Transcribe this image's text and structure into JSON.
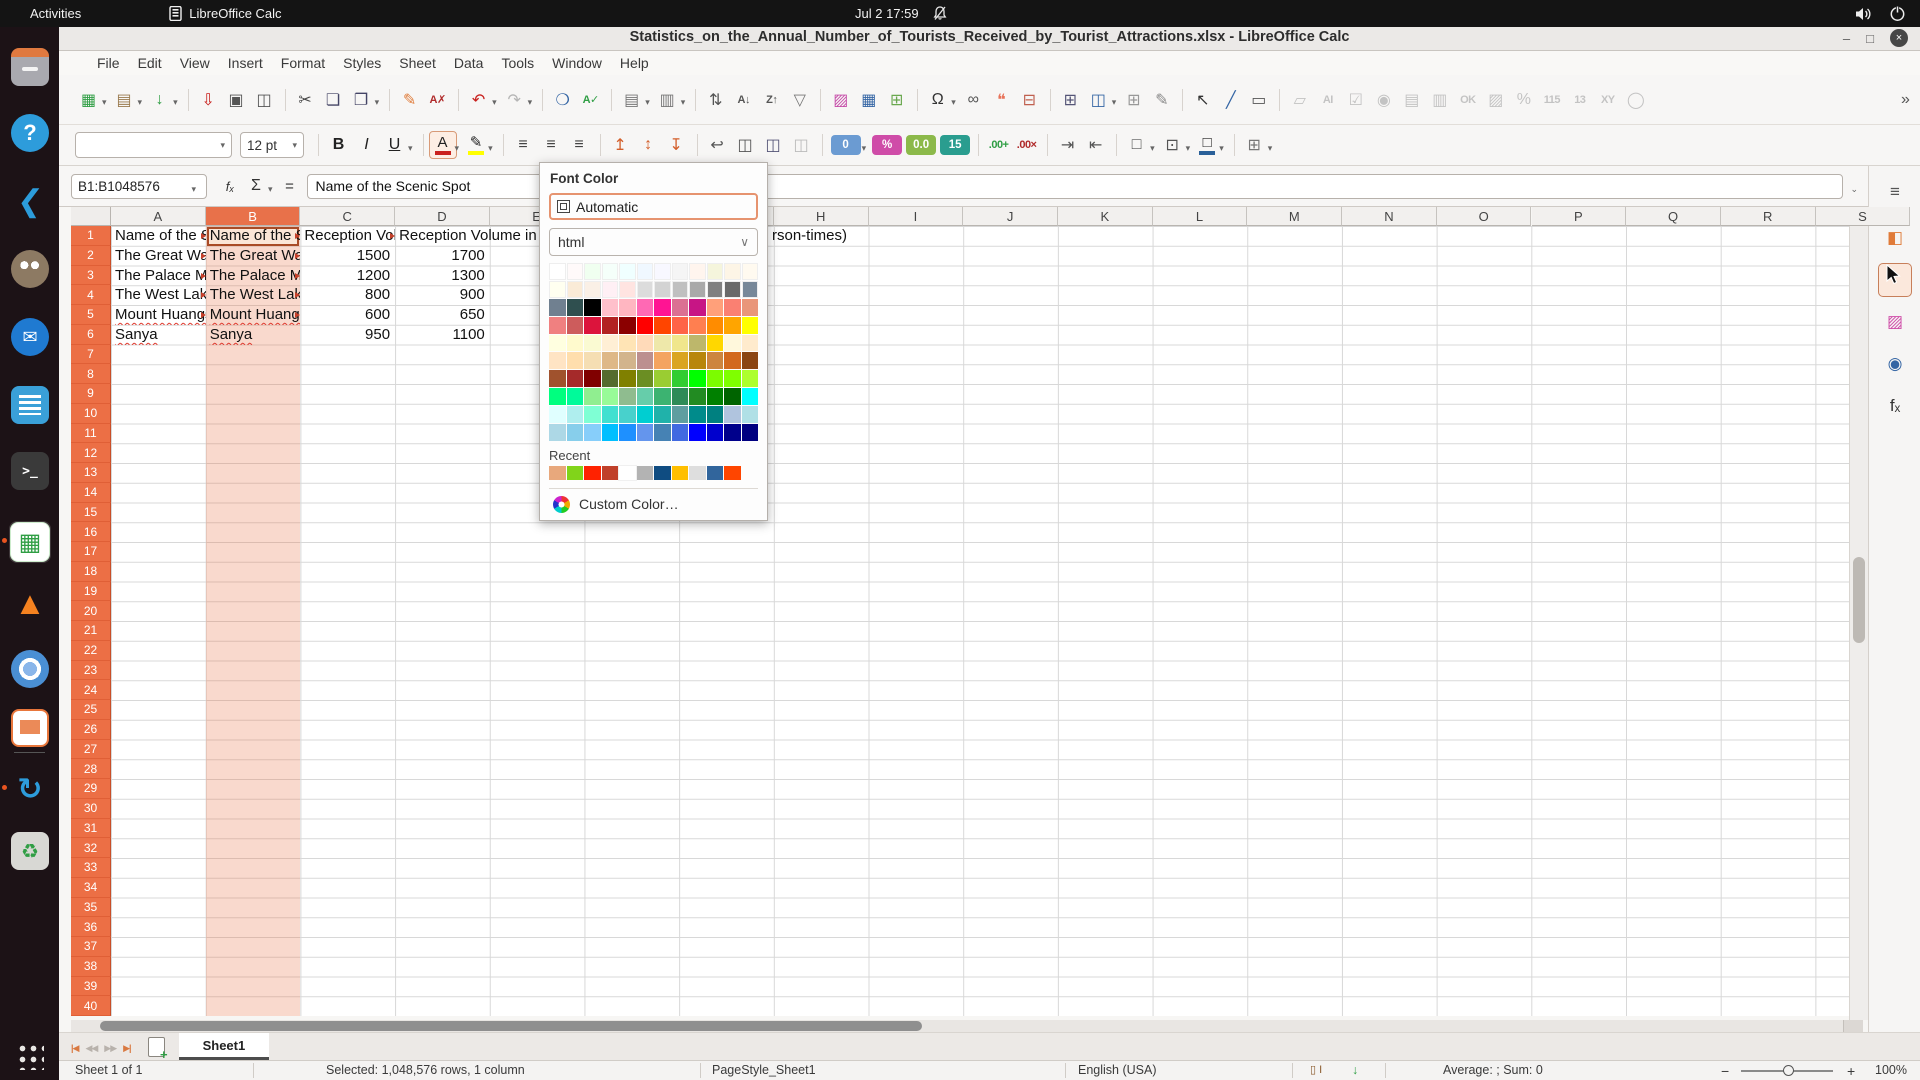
{
  "topbar": {
    "activities": "Activities",
    "app_name": "LibreOffice Calc",
    "clock": "Jul 2 17:59"
  },
  "titlebar": {
    "title": "Statistics_on_the_Annual_Number_of_Tourists_Received_by_Tourist_Attractions.xlsx - LibreOffice Calc",
    "minimize": "–",
    "maximize": "□",
    "close": "×"
  },
  "menubar": {
    "items": [
      "File",
      "Edit",
      "View",
      "Insert",
      "Format",
      "Styles",
      "Sheet",
      "Data",
      "Tools",
      "Window",
      "Help"
    ]
  },
  "toolbar_main": {
    "items": [
      {
        "name": "new",
        "glyph": "▦",
        "color": "#2f9e44",
        "dd": true
      },
      {
        "name": "open",
        "glyph": "▤",
        "color": "#9a7b4f",
        "dd": true
      },
      {
        "name": "save",
        "glyph": "↓",
        "color": "#2f9e44",
        "dd": true
      },
      {
        "name": "sep"
      },
      {
        "name": "export-pdf",
        "glyph": "⇩",
        "color": "#c9211e"
      },
      {
        "name": "print",
        "glyph": "▣",
        "color": "#555"
      },
      {
        "name": "print-preview",
        "glyph": "◫",
        "color": "#555"
      },
      {
        "name": "sep"
      },
      {
        "name": "cut",
        "glyph": "✂",
        "color": "#444"
      },
      {
        "name": "copy",
        "glyph": "❏",
        "color": "#446"
      },
      {
        "name": "paste",
        "glyph": "❐",
        "color": "#446",
        "dd": true
      },
      {
        "name": "sep"
      },
      {
        "name": "clone-formatting",
        "glyph": "✎",
        "color": "#e07b39"
      },
      {
        "name": "clear-formatting",
        "glyph": "A✗",
        "color": "#b02b2b",
        "small": true
      },
      {
        "name": "sep"
      },
      {
        "name": "undo",
        "glyph": "↶",
        "color": "#c9211e",
        "dd": true
      },
      {
        "name": "redo",
        "glyph": "↷",
        "color": "#aaa",
        "dd": true,
        "disabled": true
      },
      {
        "name": "sep"
      },
      {
        "name": "find-replace",
        "glyph": "❍",
        "color": "#3465a4"
      },
      {
        "name": "spelling",
        "glyph": "A✓",
        "color": "#2f9e44",
        "small": true
      },
      {
        "name": "sep"
      },
      {
        "name": "row",
        "glyph": "▤",
        "color": "#777",
        "dd": true
      },
      {
        "name": "column",
        "glyph": "▥",
        "color": "#777",
        "dd": true
      },
      {
        "name": "sep"
      },
      {
        "name": "sort",
        "glyph": "⇅",
        "color": "#555"
      },
      {
        "name": "sort-ascending",
        "glyph": "A↓",
        "color": "#555",
        "small": true
      },
      {
        "name": "sort-descending",
        "glyph": "Z↑",
        "color": "#555",
        "small": true
      },
      {
        "name": "autofilter",
        "glyph": "▽",
        "color": "#777"
      },
      {
        "name": "sep"
      },
      {
        "name": "insert-image",
        "glyph": "▨",
        "color": "#c64ca8"
      },
      {
        "name": "insert-chart",
        "glyph": "▦",
        "color": "#3465a4"
      },
      {
        "name": "pivot-table",
        "glyph": "⊞",
        "color": "#6aa84f"
      },
      {
        "name": "sep"
      },
      {
        "name": "special-character",
        "glyph": "Ω",
        "color": "#333",
        "dd": true
      },
      {
        "name": "hyperlink",
        "glyph": "∞",
        "color": "#555"
      },
      {
        "name": "comment",
        "glyph": "❝",
        "color": "#e8735a"
      },
      {
        "name": "headers-footers",
        "glyph": "⊟",
        "color": "#c0604f"
      },
      {
        "name": "sep"
      },
      {
        "name": "freeze-panes",
        "glyph": "⊞",
        "color": "#557"
      },
      {
        "name": "split-window",
        "glyph": "◫",
        "color": "#3465a4",
        "dd": true
      },
      {
        "name": "show-grid",
        "glyph": "⊞",
        "color": "#999"
      },
      {
        "name": "show-draw-functions",
        "glyph": "✎",
        "color": "#888"
      },
      {
        "name": "sep"
      },
      {
        "name": "select",
        "glyph": "↖",
        "color": "#333"
      },
      {
        "name": "insert-line",
        "glyph": "╱",
        "color": "#3465a4"
      },
      {
        "name": "insert-text-box",
        "glyph": "▭",
        "color": "#555"
      },
      {
        "name": "sep"
      },
      {
        "name": "label-field",
        "glyph": "▱",
        "color": "#bbb",
        "disabled": true
      },
      {
        "name": "text-box-field",
        "glyph": "AI",
        "color": "#bbb",
        "disabled": true,
        "small": true
      },
      {
        "name": "check-box",
        "glyph": "☑",
        "color": "#bbb",
        "disabled": true
      },
      {
        "name": "option-button",
        "glyph": "◉",
        "color": "#bbb",
        "disabled": true
      },
      {
        "name": "list-box",
        "glyph": "▤",
        "color": "#bbb",
        "disabled": true
      },
      {
        "name": "combo-box",
        "glyph": "▥",
        "color": "#bbb",
        "disabled": true
      },
      {
        "name": "push-button",
        "glyph": "OK",
        "color": "#bbb",
        "disabled": true,
        "small": true
      },
      {
        "name": "image-button",
        "glyph": "▨",
        "color": "#bbb",
        "disabled": true
      },
      {
        "name": "percent-field",
        "glyph": "%",
        "color": "#bbb",
        "disabled": true
      },
      {
        "name": "numeric-field",
        "glyph": "115",
        "color": "#bbb",
        "disabled": true,
        "small": true
      },
      {
        "name": "date-field",
        "glyph": "13",
        "color": "#bbb",
        "disabled": true,
        "small": true
      },
      {
        "name": "formatted-field",
        "glyph": "XY",
        "color": "#bbb",
        "disabled": true,
        "small": true
      },
      {
        "name": "more-controls",
        "glyph": "◯",
        "color": "#bbb",
        "disabled": true
      },
      {
        "name": "spacer"
      },
      {
        "name": "toolbar-overflow",
        "glyph": "»",
        "color": "#555"
      }
    ]
  },
  "toolbar_format": {
    "font_name_value": "",
    "font_size_value": "12 pt",
    "items": [
      {
        "type": "combo",
        "name": "font-name",
        "width": 157
      },
      {
        "type": "combo",
        "name": "font-size",
        "width": 64
      },
      {
        "type": "sep"
      },
      {
        "type": "icon",
        "name": "bold",
        "glyph": "B",
        "color": "#222",
        "cls": "b"
      },
      {
        "type": "icon",
        "name": "italic",
        "glyph": "I",
        "color": "#222",
        "cls": "i"
      },
      {
        "type": "icon",
        "name": "underline",
        "glyph": "U",
        "color": "#222",
        "cls": "u",
        "dd": true
      },
      {
        "type": "sep"
      },
      {
        "type": "colorbtn",
        "name": "font-color",
        "glyph": "A",
        "bar": "#c9211e",
        "dd": true,
        "active": true
      },
      {
        "type": "colorbtn",
        "name": "highlight-color",
        "glyph": "✎",
        "bar": "#ffff00",
        "dd": true
      },
      {
        "type": "sep"
      },
      {
        "type": "icon",
        "name": "align-left",
        "glyph": "≡",
        "color": "#444"
      },
      {
        "type": "icon",
        "name": "align-center",
        "glyph": "≡",
        "color": "#444"
      },
      {
        "type": "icon",
        "name": "align-right",
        "glyph": "≡",
        "color": "#444"
      },
      {
        "type": "sep"
      },
      {
        "type": "icon",
        "name": "align-top",
        "glyph": "↥",
        "color": "#d35f2b"
      },
      {
        "type": "icon",
        "name": "center-vertically",
        "glyph": "↕",
        "color": "#d35f2b"
      },
      {
        "type": "icon",
        "name": "align-bottom",
        "glyph": "↧",
        "color": "#d35f2b"
      },
      {
        "type": "sep"
      },
      {
        "type": "icon",
        "name": "wrap-text",
        "glyph": "↩",
        "color": "#555"
      },
      {
        "type": "icon",
        "name": "merge-cells",
        "glyph": "◫",
        "color": "#555"
      },
      {
        "type": "icon",
        "name": "merge-and-center",
        "glyph": "◫",
        "color": "#557"
      },
      {
        "type": "icon",
        "name": "unmerge-cells",
        "glyph": "◫",
        "color": "#bbb",
        "disabled": true
      },
      {
        "type": "sep"
      },
      {
        "type": "chip",
        "name": "format-number",
        "text": "0",
        "bg": "#6b9bd2",
        "dd": true
      },
      {
        "type": "chip",
        "name": "format-percent",
        "text": "%",
        "bg": "#cf4ca8"
      },
      {
        "type": "chip",
        "name": "format-decimal",
        "text": "0.0",
        "bg": "#8cb94a"
      },
      {
        "type": "chip",
        "name": "format-date",
        "text": "15",
        "bg": "#2a9d8f"
      },
      {
        "type": "sep"
      },
      {
        "type": "icon",
        "name": "add-decimal-place",
        "glyph": ".00+",
        "color": "#2f9e44",
        "small": true
      },
      {
        "type": "icon",
        "name": "delete-decimal-place",
        "glyph": ".00×",
        "color": "#b02b2b",
        "small": true
      },
      {
        "type": "sep"
      },
      {
        "type": "icon",
        "name": "increase-indent",
        "glyph": "⇥",
        "color": "#555"
      },
      {
        "type": "icon",
        "name": "decrease-indent",
        "glyph": "⇤",
        "color": "#555"
      },
      {
        "type": "sep"
      },
      {
        "type": "icon",
        "name": "borders",
        "glyph": "□",
        "color": "#555",
        "dd": true
      },
      {
        "type": "icon",
        "name": "border-style",
        "glyph": "⊡",
        "color": "#555",
        "dd": true
      },
      {
        "type": "colorbtn",
        "name": "border-color",
        "glyph": "□",
        "bar": "#2a6099",
        "dd": true
      },
      {
        "type": "sep"
      },
      {
        "type": "icon",
        "name": "conditional-formatting",
        "glyph": "⊞",
        "color": "#777",
        "dd": true
      }
    ]
  },
  "formula_bar": {
    "cell_reference": "B1:B1048576",
    "fx_label": "fₓ",
    "sum_label": "Σ",
    "equals_label": "=",
    "content": "Name of the Scenic Spot"
  },
  "font_color_popup": {
    "title": "Font Color",
    "automatic_label": "Automatic",
    "palette_name": "html",
    "palette": [
      [
        "#FFFFFF",
        "#FFFAFA",
        "#F0FFF0",
        "#F5FFFA",
        "#F0FFFF",
        "#F0F8FF",
        "#F8F8FF",
        "#F5F5F5",
        "#FFF5EE",
        "#F5F5DC",
        "#FDF5E6",
        "#FFFAF0"
      ],
      [
        "#FFFFF0",
        "#FAEBD7",
        "#FAF0E6",
        "#FFF0F5",
        "#FFE4E1",
        "#DCDCDC",
        "#D3D3D3",
        "#C0C0C0",
        "#A9A9A9",
        "#808080",
        "#696969",
        "#778899"
      ],
      [
        "#708090",
        "#2F4F4F",
        "#000000",
        "#FFC0CB",
        "#FFB6C1",
        "#FF69B4",
        "#FF1493",
        "#DB7093",
        "#C71585",
        "#FFA07A",
        "#FA8072",
        "#E9967A"
      ],
      [
        "#F08080",
        "#CD5C5C",
        "#DC143C",
        "#B22222",
        "#8B0000",
        "#FF0000",
        "#FF4500",
        "#FF6347",
        "#FF7F50",
        "#FF8C00",
        "#FFA500",
        "#FFFF00"
      ],
      [
        "#FFFFE0",
        "#FFFACD",
        "#FAFAD2",
        "#FFEFD5",
        "#FFE4B5",
        "#FFDAB9",
        "#EEE8AA",
        "#F0E68C",
        "#BDB76B",
        "#FFD700",
        "#FFF8DC",
        "#FFEBCD"
      ],
      [
        "#FFE4C4",
        "#FFDEAD",
        "#F5DEB3",
        "#DEB887",
        "#D2B48C",
        "#BC8F8F",
        "#F4A460",
        "#DAA520",
        "#B8860B",
        "#CD853F",
        "#D2691E",
        "#8B4513"
      ],
      [
        "#A0522D",
        "#A52A2A",
        "#800000",
        "#556B2F",
        "#808000",
        "#6B8E23",
        "#9ACD32",
        "#32CD32",
        "#00FF00",
        "#7CFC00",
        "#7FFF00",
        "#ADFF2F"
      ],
      [
        "#00FF7F",
        "#00FA9A",
        "#90EE90",
        "#98FB98",
        "#8FBC8F",
        "#66CDAA",
        "#3CB371",
        "#2E8B57",
        "#228B22",
        "#008000",
        "#006400",
        "#00FFFF"
      ],
      [
        "#E0FFFF",
        "#AFEEEE",
        "#7FFFD4",
        "#40E0D0",
        "#48D1CC",
        "#00CED1",
        "#20B2AA",
        "#5F9EA0",
        "#008B8B",
        "#008080",
        "#B0C4DE",
        "#B0E0E6"
      ],
      [
        "#ADD8E6",
        "#87CEEB",
        "#87CEFA",
        "#00BFFF",
        "#1E90FF",
        "#6495ED",
        "#4682B4",
        "#4169E1",
        "#0000FF",
        "#0000CD",
        "#00008B",
        "#000080"
      ]
    ],
    "recent_label": "Recent",
    "recent": [
      "#E8A87C",
      "#81D41A",
      "#FF2200",
      "#C0402A",
      "#FFFFFF",
      "#B3B3B3",
      "#0F4C81",
      "#FFBF00",
      "#DEDEDE",
      "#31659C",
      "#FF4500"
    ],
    "custom_label": "Custom Color…"
  },
  "sheet": {
    "columns": [
      "A",
      "B",
      "C",
      "D",
      "E",
      "F",
      "G",
      "H",
      "I",
      "J",
      "K",
      "L",
      "M",
      "N",
      "O",
      "P",
      "Q",
      "R",
      "S"
    ],
    "selected_column": "B",
    "visible_rows": 40,
    "data": {
      "names": [
        "Name of the Scenic Spot",
        "The Great Wall",
        "The Palace Museum",
        "The West Lake",
        "Mount Huangshan",
        "Sanya"
      ],
      "c_values": [
        "Reception Volume in 2016(10,000 person-times)",
        "1500",
        "1200",
        "800",
        "600",
        "950"
      ],
      "d_values": [
        "Reception Volume in 2017(10,000 person-times)",
        "1700",
        "1300",
        "900",
        "650",
        "1100"
      ],
      "d1_visible_tail": "rson-times)",
      "misspelled_rows": [
        5,
        6
      ],
      "truncated_rows": [
        1,
        2,
        3,
        4,
        5
      ]
    }
  },
  "sheet_tabs": {
    "nav": [
      {
        "name": "first-sheet",
        "glyph": "|◀",
        "color": "#d97941"
      },
      {
        "name": "previous-sheet",
        "glyph": "◀◀",
        "color": "#b8b2ac"
      },
      {
        "name": "next-sheet",
        "glyph": "▶▶",
        "color": "#b8b2ac"
      },
      {
        "name": "last-sheet",
        "glyph": "▶|",
        "color": "#d97941"
      }
    ],
    "active": "Sheet1"
  },
  "status_bar": {
    "sheet_info": "Sheet 1 of 1",
    "selection_info": "Selected: 1,048,576 rows, 1 column",
    "page_style": "PageStyle_Sheet1",
    "language": "English (USA)",
    "selection_mode_glyph": "▯ I",
    "modified_glyph": "↓",
    "aggregate": "Average: ; Sum: 0",
    "zoom_minus": "−",
    "zoom_plus": "+",
    "zoom_level": "100%"
  },
  "dock": {
    "items": [
      {
        "name": "files"
      },
      {
        "name": "help"
      },
      {
        "name": "vscode"
      },
      {
        "name": "gimp"
      },
      {
        "name": "thunderbird"
      },
      {
        "name": "writer"
      },
      {
        "name": "terminal"
      },
      {
        "name": "calc",
        "active": true,
        "dot": true
      },
      {
        "name": "vlc"
      },
      {
        "name": "chromium"
      },
      {
        "name": "impress"
      },
      {
        "name": "separator"
      },
      {
        "name": "updater",
        "dot": true
      },
      {
        "name": "trash"
      }
    ],
    "glyphs": {
      "help": "?",
      "vscode": "❮",
      "thunderbird": "✉",
      "terminal": "&gt;_",
      "calc": "▦",
      "vlc": "▲",
      "updater": "↻",
      "trash": "♻",
      "files": "",
      "gimp": "",
      "writer": "",
      "chromium": "",
      "impress": ""
    }
  },
  "sidebar": {
    "tabs": [
      {
        "name": "sidebar-settings",
        "glyph": "≡",
        "color": "#555"
      },
      {
        "name": "properties",
        "glyph": "◧",
        "color": "#e07b39"
      },
      {
        "name": "styles",
        "glyph": "cursor",
        "color": "#222",
        "hover": true
      },
      {
        "name": "gallery",
        "glyph": "▨",
        "color": "#cf4ca8"
      },
      {
        "name": "navigator",
        "glyph": "◉",
        "color": "#3465a4"
      },
      {
        "name": "functions",
        "glyph": "fₓ",
        "color": "#333"
      }
    ]
  }
}
